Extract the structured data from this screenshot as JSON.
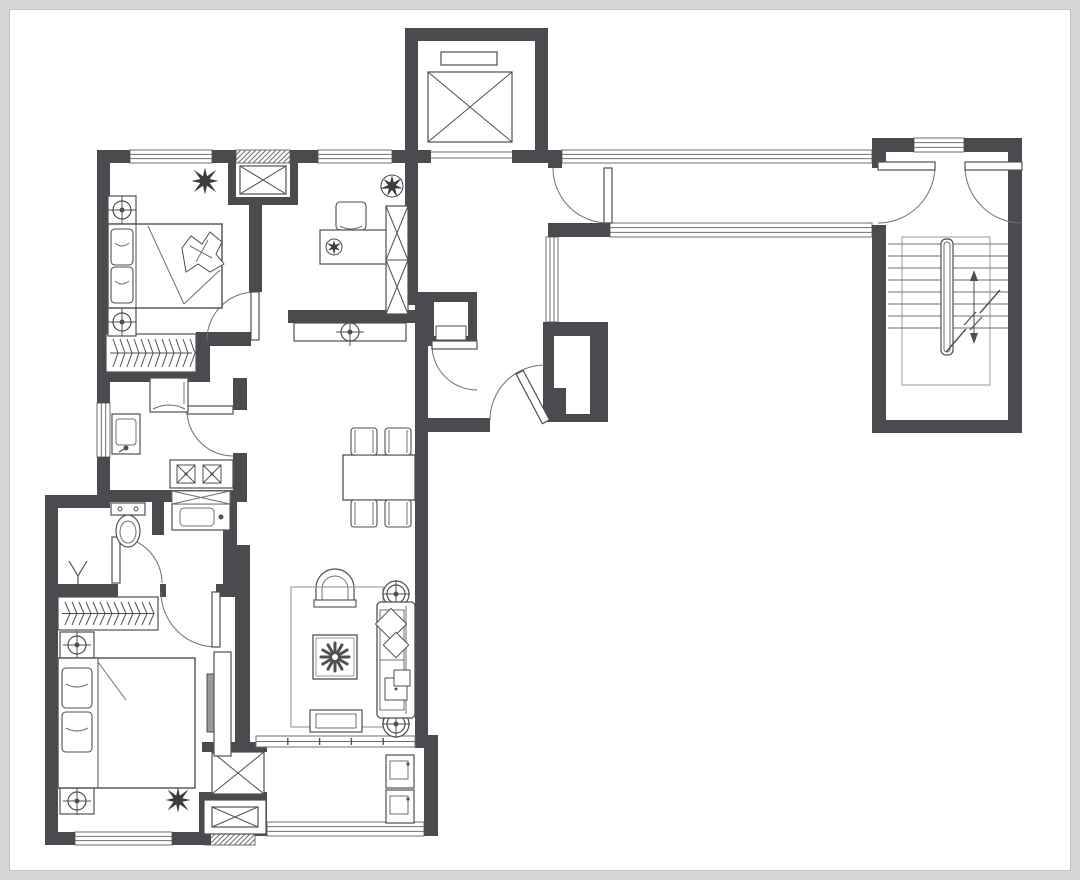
{
  "canvas": {
    "w": 1080,
    "h": 880
  },
  "style": {
    "wall_color": "#4b4b4f",
    "stroke_color": "#4f4f4f",
    "mid_color": "#6f6f6f",
    "light_color": "#989898",
    "plant_color": "#3c3c3c",
    "white": "#ffffff"
  },
  "plan": {
    "walls": [
      [
        97,
        150,
        33,
        13
      ],
      [
        212,
        150,
        16,
        13
      ],
      [
        228,
        150,
        8,
        55
      ],
      [
        290,
        150,
        8,
        55
      ],
      [
        228,
        197,
        70,
        8
      ],
      [
        298,
        150,
        20,
        13
      ],
      [
        392,
        150,
        26,
        13
      ],
      [
        405,
        28,
        143,
        13
      ],
      [
        405,
        28,
        13,
        135
      ],
      [
        535,
        28,
        13,
        135
      ],
      [
        405,
        150,
        26,
        13
      ],
      [
        512,
        150,
        36,
        13
      ],
      [
        548,
        150,
        14,
        18
      ],
      [
        872,
        138,
        42,
        14
      ],
      [
        964,
        138,
        58,
        14
      ],
      [
        1008,
        138,
        14,
        295
      ],
      [
        872,
        152,
        14,
        16
      ],
      [
        872,
        225,
        14,
        208
      ],
      [
        872,
        420,
        150,
        13
      ],
      [
        548,
        223,
        62,
        14
      ],
      [
        543,
        322,
        65,
        100
      ],
      [
        428,
        418,
        62,
        14
      ],
      [
        415,
        292,
        13,
        140
      ],
      [
        428,
        292,
        49,
        54
      ],
      [
        405,
        163,
        13,
        142
      ],
      [
        288,
        310,
        130,
        13
      ],
      [
        249,
        205,
        13,
        87
      ],
      [
        196,
        332,
        55,
        14
      ],
      [
        196,
        332,
        14,
        50
      ],
      [
        97,
        163,
        13,
        240
      ],
      [
        97,
        457,
        13,
        45
      ],
      [
        97,
        372,
        99,
        10
      ],
      [
        233,
        378,
        14,
        32
      ],
      [
        233,
        453,
        14,
        49
      ],
      [
        97,
        490,
        150,
        12
      ],
      [
        152,
        502,
        12,
        33
      ],
      [
        223,
        502,
        14,
        82
      ],
      [
        45,
        495,
        65,
        13
      ],
      [
        45,
        495,
        13,
        350
      ],
      [
        45,
        584,
        73,
        13
      ],
      [
        160,
        584,
        6,
        13
      ],
      [
        216,
        584,
        34,
        13
      ],
      [
        235,
        545,
        15,
        203
      ],
      [
        202,
        742,
        65,
        10
      ],
      [
        202,
        792,
        65,
        8
      ],
      [
        199,
        792,
        12,
        53
      ],
      [
        45,
        832,
        30,
        13
      ],
      [
        172,
        832,
        33,
        13
      ],
      [
        255,
        795,
        12,
        41
      ],
      [
        424,
        742,
        14,
        94
      ],
      [
        415,
        735,
        23,
        13
      ],
      [
        415,
        415,
        13,
        327
      ]
    ],
    "inner_whites": [
      [
        554,
        336,
        36,
        52
      ],
      [
        566,
        368,
        24,
        46
      ],
      [
        434,
        302,
        34,
        34
      ]
    ],
    "cabinet_rects": [
      [
        436,
        326,
        30,
        14
      ]
    ],
    "windows": [
      {
        "r": [
          130,
          150,
          82,
          13
        ],
        "o": "h"
      },
      {
        "r": [
          318,
          150,
          74,
          13
        ],
        "o": "h"
      },
      {
        "r": [
          562,
          150,
          310,
          13
        ],
        "o": "h"
      },
      {
        "r": [
          914,
          138,
          50,
          14
        ],
        "o": "h"
      },
      {
        "r": [
          610,
          223,
          262,
          14
        ],
        "o": "h"
      },
      {
        "r": [
          546,
          237,
          12,
          85
        ],
        "o": "v"
      },
      {
        "r": [
          97,
          403,
          13,
          54
        ],
        "o": "v"
      },
      {
        "r": [
          75,
          832,
          97,
          13
        ],
        "o": "h"
      },
      {
        "r": [
          267,
          822,
          157,
          14
        ],
        "o": "h"
      }
    ],
    "hatches": [
      [
        236,
        150,
        54,
        13
      ],
      [
        205,
        834,
        50,
        11
      ]
    ],
    "herringbones": [
      [
        106,
        334,
        90,
        38
      ],
      [
        58,
        597,
        100,
        33
      ]
    ],
    "xboxes": [
      [
        240,
        166,
        46,
        28
      ],
      [
        212,
        752,
        52,
        42
      ]
    ],
    "louvers": [
      {
        "r": [
          204,
          800,
          62,
          34
        ],
        "inner": [
          212,
          807,
          46,
          20
        ]
      }
    ],
    "sliding": [
      [
        256,
        736,
        159,
        11
      ]
    ],
    "doors": [
      {
        "n": "bedroom1-door",
        "c": [
          255,
          340
        ],
        "r": 48,
        "a1": 180,
        "a2": 270,
        "leaf": [
          251,
          292,
          8,
          48
        ]
      },
      {
        "n": "kitchen-door",
        "c": [
          233,
          410
        ],
        "r": 46,
        "a1": 90,
        "a2": 180,
        "leaf": [
          187,
          406,
          46,
          8
        ]
      },
      {
        "n": "bathroom-door",
        "c": [
          116,
          583
        ],
        "r": 46,
        "a1": 270,
        "a2": 360,
        "leaf": [
          112,
          537,
          8,
          46
        ]
      },
      {
        "n": "bedroom2-door",
        "c": [
          216,
          592
        ],
        "r": 55,
        "a1": 90,
        "a2": 180,
        "leaf": [
          212,
          592,
          8,
          55
        ]
      },
      {
        "n": "lobby-door",
        "c": [
          608,
          168
        ],
        "r": 55,
        "a1": 90,
        "a2": 180,
        "leaf": [
          604,
          168,
          8,
          55
        ]
      },
      {
        "n": "stair-door-left",
        "c": [
          878,
          166
        ],
        "r": 57,
        "a1": 0,
        "a2": 90,
        "leaf": [
          878,
          162,
          57,
          8
        ]
      },
      {
        "n": "stair-door-right",
        "c": [
          1022,
          166
        ],
        "r": 57,
        "a1": 90,
        "a2": 180,
        "leaf": [
          965,
          162,
          57,
          8
        ]
      },
      {
        "n": "entry-door",
        "c": [
          545,
          420
        ],
        "r": 55,
        "a1": 180,
        "a2": 270,
        "leaf": [
          541,
          366,
          8,
          56
        ],
        "rot": -28
      },
      {
        "n": "vestibule-door",
        "c": [
          477,
          345
        ],
        "r": 45,
        "a1": 90,
        "a2": 180,
        "leaf": [
          432,
          341,
          45,
          8
        ]
      }
    ],
    "elevator": {
      "car": [
        428,
        72,
        84,
        70
      ],
      "top": [
        441,
        52,
        56,
        13
      ],
      "sills": [
        [
          431,
          152,
          81
        ],
        [
          431,
          158,
          81
        ]
      ]
    },
    "stairs": {
      "x1": 888,
      "x2": 1008,
      "treads": [
        244,
        256,
        268,
        280,
        292,
        304,
        316,
        328
      ],
      "landing": [
        902,
        237,
        88,
        148
      ],
      "rail": [
        941,
        239,
        12,
        116
      ],
      "arrow": {
        "x1": 946,
        "y1": 352,
        "x2": 1000,
        "y2": 290,
        "vx": 974,
        "vy1": 270,
        "vy2": 344
      }
    },
    "furniture": [
      {
        "t": "nightstand",
        "n": "nightstand",
        "r": [
          108,
          196,
          28,
          28
        ]
      },
      {
        "t": "nightstand",
        "n": "nightstand",
        "r": [
          108,
          308,
          28,
          28
        ]
      },
      {
        "t": "bed",
        "n": "bed-secondary",
        "r": [
          108,
          224,
          114,
          84
        ],
        "inner": 136,
        "pillows": [
          [
            111,
            229,
            22,
            36
          ],
          [
            111,
            267,
            22,
            36
          ]
        ],
        "crumple": [
          182,
          232,
          42,
          42
        ],
        "fold": [
          [
            148,
            226,
            184,
            304
          ],
          [
            184,
            304,
            220,
            270
          ]
        ]
      },
      {
        "t": "plant",
        "n": "plant",
        "c": [
          205,
          181
        ],
        "r": 16
      },
      {
        "t": "chair",
        "n": "desk-chair",
        "r": [
          336,
          202,
          30,
          28
        ]
      },
      {
        "t": "desk",
        "n": "desk",
        "r": [
          320,
          230,
          68,
          34
        ],
        "pot": [
          334,
          247
        ]
      },
      {
        "t": "shelf",
        "n": "bookshelf",
        "r": [
          386,
          206,
          22,
          108
        ],
        "cells": 2
      },
      {
        "t": "plantpot",
        "n": "potted-plant",
        "c": [
          392,
          186
        ],
        "r": 11
      },
      {
        "t": "cabinet",
        "n": "console-cabinet",
        "r": [
          294,
          323,
          112,
          18
        ],
        "lamp": [
          350,
          332
        ]
      },
      {
        "t": "fridge",
        "n": "fridge",
        "r": [
          150,
          378,
          38,
          34
        ]
      },
      {
        "t": "ksink",
        "n": "kitchen-sink",
        "r": [
          112,
          414,
          28,
          40
        ]
      },
      {
        "t": "cooktop",
        "n": "cooktop",
        "r": [
          170,
          460,
          63,
          28
        ]
      },
      {
        "t": "toilet",
        "n": "toilet",
        "c": [
          128,
          520
        ]
      },
      {
        "t": "vanity",
        "n": "vanity-sink",
        "r": [
          172,
          504,
          58,
          26
        ]
      },
      {
        "t": "mirrorx",
        "n": "mirror-cabinet",
        "r": [
          172,
          491,
          58,
          13
        ]
      },
      {
        "t": "ysym",
        "n": "floor-lamp",
        "c": [
          78,
          574
        ]
      },
      {
        "t": "nightstand",
        "n": "nightstand",
        "r": [
          60,
          632,
          34,
          26
        ]
      },
      {
        "t": "nightstand",
        "n": "nightstand",
        "r": [
          60,
          788,
          34,
          26
        ]
      },
      {
        "t": "bed",
        "n": "bed-master",
        "r": [
          58,
          658,
          137,
          130
        ],
        "inner": 98,
        "pillows": [
          [
            62,
            668,
            30,
            40
          ],
          [
            62,
            712,
            30,
            40
          ]
        ],
        "fold": [
          [
            98,
            662,
            126,
            700
          ]
        ]
      },
      {
        "t": "plant",
        "n": "plant",
        "c": [
          178,
          800
        ],
        "r": 15
      },
      {
        "t": "tvcab",
        "n": "tv-cabinet",
        "r": [
          214,
          652,
          17,
          104
        ],
        "panel": [
          207,
          674,
          7,
          58
        ]
      },
      {
        "t": "archchair",
        "n": "armchair",
        "c": [
          335,
          588
        ],
        "ro": 19,
        "ri": 13,
        "base": [
          314,
          600,
          42,
          7
        ]
      },
      {
        "t": "rug",
        "n": "rug",
        "r": [
          291,
          587,
          92,
          140
        ]
      },
      {
        "t": "ctable",
        "n": "coffee-table",
        "r": [
          313,
          635,
          44,
          44
        ]
      },
      {
        "t": "rtable",
        "n": "side-table",
        "c": [
          396,
          594
        ],
        "r": 13
      },
      {
        "t": "rtable",
        "n": "side-table",
        "c": [
          396,
          724
        ],
        "r": 13
      },
      {
        "t": "sofa",
        "n": "sofa",
        "r": [
          377,
          602,
          38,
          116
        ]
      },
      {
        "t": "tvbench",
        "n": "tv-bench",
        "r": [
          310,
          710,
          52,
          22
        ]
      },
      {
        "t": "washer",
        "n": "washing-machine",
        "r": [
          386,
          755,
          28,
          33
        ]
      },
      {
        "t": "washer",
        "n": "dryer",
        "r": [
          386,
          790,
          28,
          33
        ]
      },
      {
        "t": "dining",
        "n": "dining-table",
        "r": [
          343,
          455,
          72,
          45
        ],
        "chairs": [
          [
            351,
            428,
            26,
            27
          ],
          [
            385,
            428,
            26,
            27
          ],
          [
            351,
            500,
            26,
            27
          ],
          [
            385,
            500,
            26,
            27
          ]
        ]
      }
    ]
  }
}
